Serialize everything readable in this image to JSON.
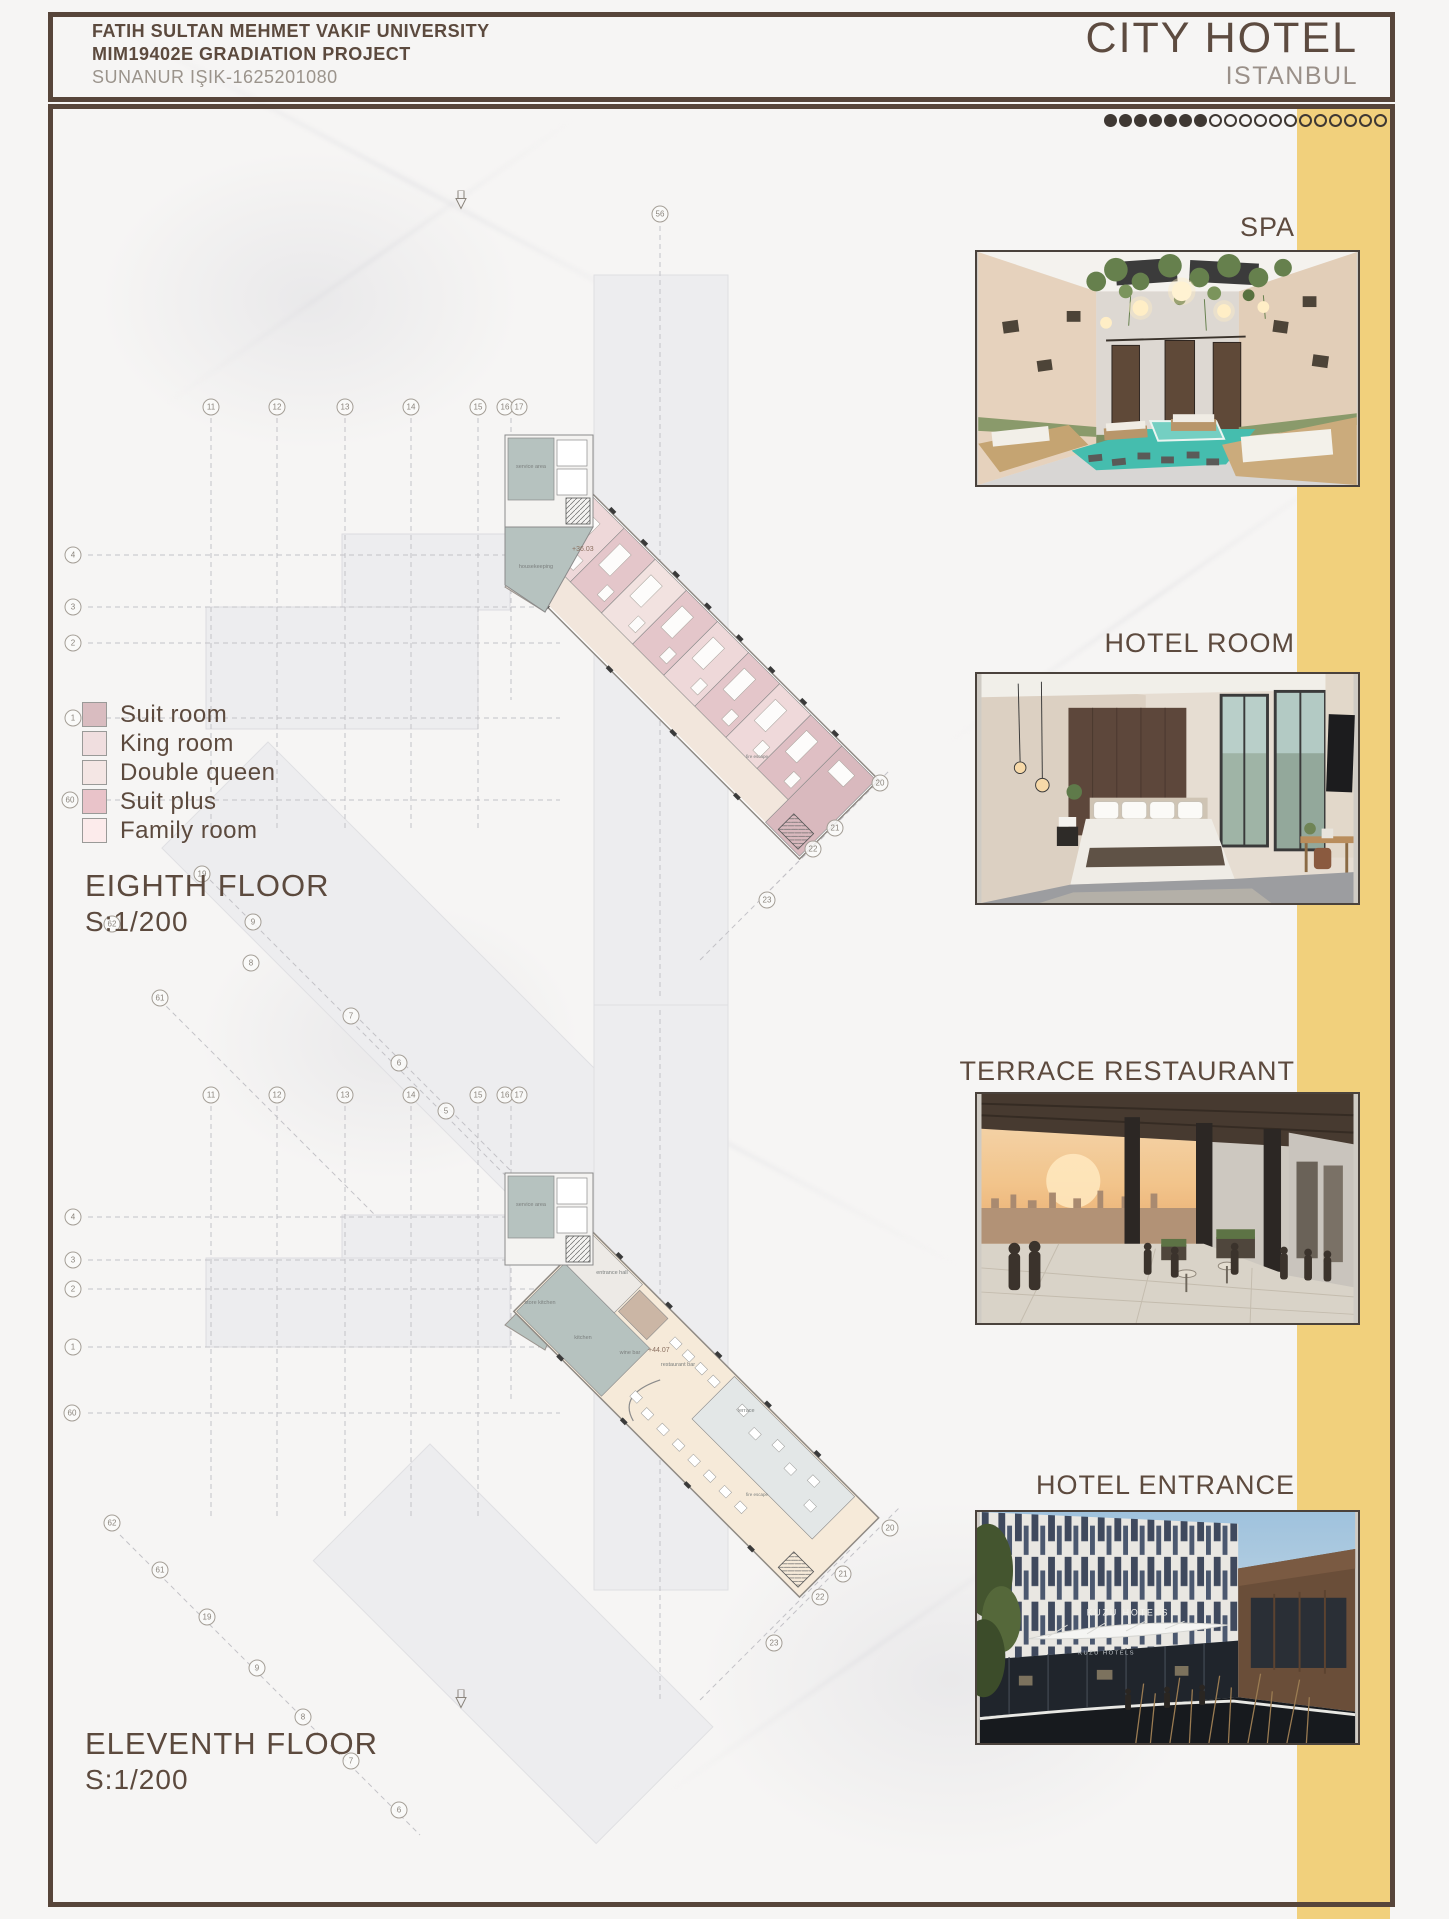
{
  "header": {
    "line1": "FATIH SULTAN MEHMET VAKIF UNIVERSITY",
    "line2": "MIM19402E GRADIATION PROJECT",
    "line3": "SUNANUR IŞIK-1625201080",
    "title": "CITY HOTEL",
    "subtitle": "ISTANBUL"
  },
  "progress": {
    "filled": 7,
    "open": 12
  },
  "colors": {
    "accent_yellow": "#f1d07c",
    "frame_brown": "#57453a",
    "text_brown": "#5c4a3e",
    "muted_gray": "#9b948c",
    "plan_service_teal": "#b6c2bf",
    "plan_corridor_cream": "#f2e6dc"
  },
  "renders": [
    {
      "label": "SPA"
    },
    {
      "label": "HOTEL ROOM"
    },
    {
      "label": "TERRACE RESTAURANT"
    },
    {
      "label": "HOTEL ENTRANCE",
      "sign_text": "KUZU HOTELS"
    }
  ],
  "legend": {
    "items": [
      {
        "label": "Suit room",
        "color": "#d9bcc0"
      },
      {
        "label": "King room",
        "color": "#f0dedf"
      },
      {
        "label": "Double queen",
        "color": "#f4e6e4"
      },
      {
        "label": "Suit plus",
        "color": "#e9c3c9"
      },
      {
        "label": "Family room",
        "color": "#fcebeb"
      }
    ]
  },
  "floors": [
    {
      "title": "EIGHTH FLOOR",
      "scale": "S:1/200",
      "level_mark": "+36.03",
      "labels": [
        "service area",
        "housekeeping",
        "fire escape"
      ]
    },
    {
      "title": "ELEVENTH FLOOR",
      "scale": "S:1/200",
      "level_mark": "+44.07",
      "labels": [
        "service area",
        "store kitchen",
        "entrance hall",
        "kitchen",
        "wine bar",
        "restaurant bar",
        "terrace",
        "fire escape"
      ]
    }
  ],
  "grid_bubbles": [
    {
      "label": "56",
      "x": 660,
      "y": 214
    },
    {
      "label": "11",
      "x": 211,
      "y": 407
    },
    {
      "label": "12",
      "x": 277,
      "y": 407
    },
    {
      "label": "13",
      "x": 345,
      "y": 407
    },
    {
      "label": "14",
      "x": 411,
      "y": 407
    },
    {
      "label": "15",
      "x": 478,
      "y": 407
    },
    {
      "label": "16",
      "x": 505,
      "y": 407
    },
    {
      "label": "17",
      "x": 519,
      "y": 407
    },
    {
      "label": "4",
      "x": 73,
      "y": 555
    },
    {
      "label": "3",
      "x": 73,
      "y": 607
    },
    {
      "label": "2",
      "x": 73,
      "y": 643
    },
    {
      "label": "1",
      "x": 73,
      "y": 718
    },
    {
      "label": "60",
      "x": 70,
      "y": 800
    },
    {
      "label": "19",
      "x": 202,
      "y": 874
    },
    {
      "label": "9",
      "x": 253,
      "y": 922
    },
    {
      "label": "8",
      "x": 251,
      "y": 963
    },
    {
      "label": "62",
      "x": 112,
      "y": 924
    },
    {
      "label": "61",
      "x": 160,
      "y": 998
    },
    {
      "label": "20",
      "x": 880,
      "y": 783
    },
    {
      "label": "21",
      "x": 835,
      "y": 828
    },
    {
      "label": "22",
      "x": 813,
      "y": 849
    },
    {
      "label": "23",
      "x": 767,
      "y": 900
    },
    {
      "label": "7",
      "x": 351,
      "y": 1016
    },
    {
      "label": "6",
      "x": 399,
      "y": 1063
    },
    {
      "label": "11",
      "x": 211,
      "y": 1095
    },
    {
      "label": "12",
      "x": 277,
      "y": 1095
    },
    {
      "label": "13",
      "x": 345,
      "y": 1095
    },
    {
      "label": "14",
      "x": 411,
      "y": 1095
    },
    {
      "label": "15",
      "x": 478,
      "y": 1095
    },
    {
      "label": "16",
      "x": 505,
      "y": 1095
    },
    {
      "label": "17",
      "x": 519,
      "y": 1095
    },
    {
      "label": "5",
      "x": 446,
      "y": 1111
    },
    {
      "label": "4",
      "x": 73,
      "y": 1217
    },
    {
      "label": "3",
      "x": 73,
      "y": 1260
    },
    {
      "label": "2",
      "x": 73,
      "y": 1289
    },
    {
      "label": "1",
      "x": 73,
      "y": 1347
    },
    {
      "label": "60",
      "x": 72,
      "y": 1413
    },
    {
      "label": "62",
      "x": 112,
      "y": 1523
    },
    {
      "label": "61",
      "x": 160,
      "y": 1570
    },
    {
      "label": "19",
      "x": 207,
      "y": 1617
    },
    {
      "label": "9",
      "x": 257,
      "y": 1668
    },
    {
      "label": "8",
      "x": 303,
      "y": 1717
    },
    {
      "label": "7",
      "x": 351,
      "y": 1761
    },
    {
      "label": "6",
      "x": 399,
      "y": 1810
    },
    {
      "label": "20",
      "x": 890,
      "y": 1528
    },
    {
      "label": "21",
      "x": 843,
      "y": 1574
    },
    {
      "label": "22",
      "x": 820,
      "y": 1597
    },
    {
      "label": "23",
      "x": 774,
      "y": 1643
    }
  ]
}
